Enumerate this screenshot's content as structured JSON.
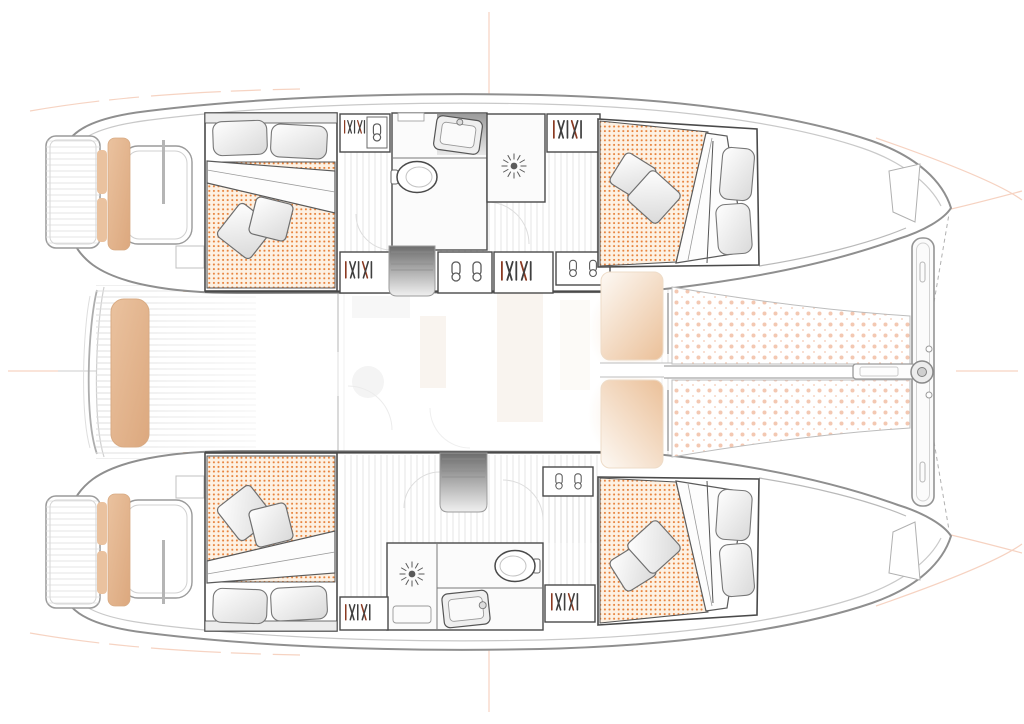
{
  "document": {
    "title": "Catamaran deck / accommodation plan",
    "view": "top-down floor plan, bow pointing right",
    "text_content": "none (drawing only)"
  },
  "palette": {
    "background": "#ffffff",
    "hull_line": "#8f8f8f",
    "hull_line_soft": "#c9c9c9",
    "wall_line": "#4a4a4a",
    "box_line": "#9b9b9b",
    "mattress_bg": "#fdf1e3",
    "mattress_dot": "#e8823b",
    "trampoline_dot": "#f3c8b2",
    "cushion": "#eac29f",
    "cushion_deep": "#dca87e",
    "cushion_edge": "#d8ab84",
    "deck_line": "#dedede",
    "floor_line": "#d2d2d2",
    "stairs_dark": "#6d6d6d",
    "stairs_light": "#f0f0f0",
    "pillow_light": "#ffffff",
    "pillow_shade": "#d9d9d9",
    "seat_fade": "#fdf9f4",
    "seat_cream": "#ecc49f",
    "saloon_blob": "#f2d9c0",
    "icon_gray": "#5a5a5a",
    "hanger_accent": "#8a3a22",
    "guide": "#efae8f"
  },
  "plan": {
    "hulls": [
      {
        "id": "port-hull",
        "position": "top",
        "rooms": [
          {
            "name": "aft double cabin",
            "furniture": [
              "double berth",
              "2 flat pillows",
              "2 scatter cushions",
              "folded duvet",
              "headboard shelf"
            ]
          },
          {
            "name": "bathroom",
            "fixtures": [
              "vanity sink",
              "toilet",
              "shower with drain rose"
            ]
          },
          {
            "name": "forward double cabin",
            "furniture": [
              "double berth",
              "2 flat pillows",
              "2 scatter cushions",
              "folded duvet"
            ]
          }
        ],
        "storage": [
          "wardrobe with hangers",
          "shoe lockers",
          "hanging locker"
        ],
        "circulation": [
          "companionway stairs",
          "corridor with plank floor"
        ],
        "aft_deck": [
          "swim platform",
          "transom seat",
          "engine hatch"
        ]
      },
      {
        "id": "starboard-hull",
        "position": "bottom",
        "rooms": [
          {
            "name": "aft double cabin",
            "furniture": [
              "double berth",
              "2 flat pillows",
              "2 scatter cushions",
              "folded duvet",
              "headboard shelf"
            ]
          },
          {
            "name": "bathroom",
            "fixtures": [
              "vanity sink",
              "toilet",
              "shower with drain rose"
            ]
          },
          {
            "name": "forward double cabin",
            "furniture": [
              "double berth",
              "2 flat pillows",
              "2 scatter cushions",
              "folded duvet"
            ]
          }
        ],
        "storage": [
          "wardrobe with hangers",
          "shoe lockers",
          "hanging locker"
        ],
        "circulation": [
          "companionway stairs",
          "corridor with plank floor"
        ],
        "aft_deck": [
          "swim platform",
          "transom seat",
          "engine hatch"
        ]
      }
    ],
    "bridgedeck": {
      "aft_cockpit": [
        "teak deck stripes",
        "cockpit bench cushion",
        "corner pads"
      ],
      "saloon": "ghosted (faded) upper-deck saloon furniture",
      "foredeck": [
        "two forward lounging seats",
        "center walkway"
      ]
    },
    "bow_area": {
      "trampoline": "two netted halves with dotted pattern",
      "structure": [
        "forward crossbeam",
        "bowsprit",
        "central fitting",
        "bridle lines (dashed)"
      ]
    },
    "guide_marks": [
      "center-line crosshairs at page edges",
      "faint sheer guide curves at corners"
    ]
  }
}
